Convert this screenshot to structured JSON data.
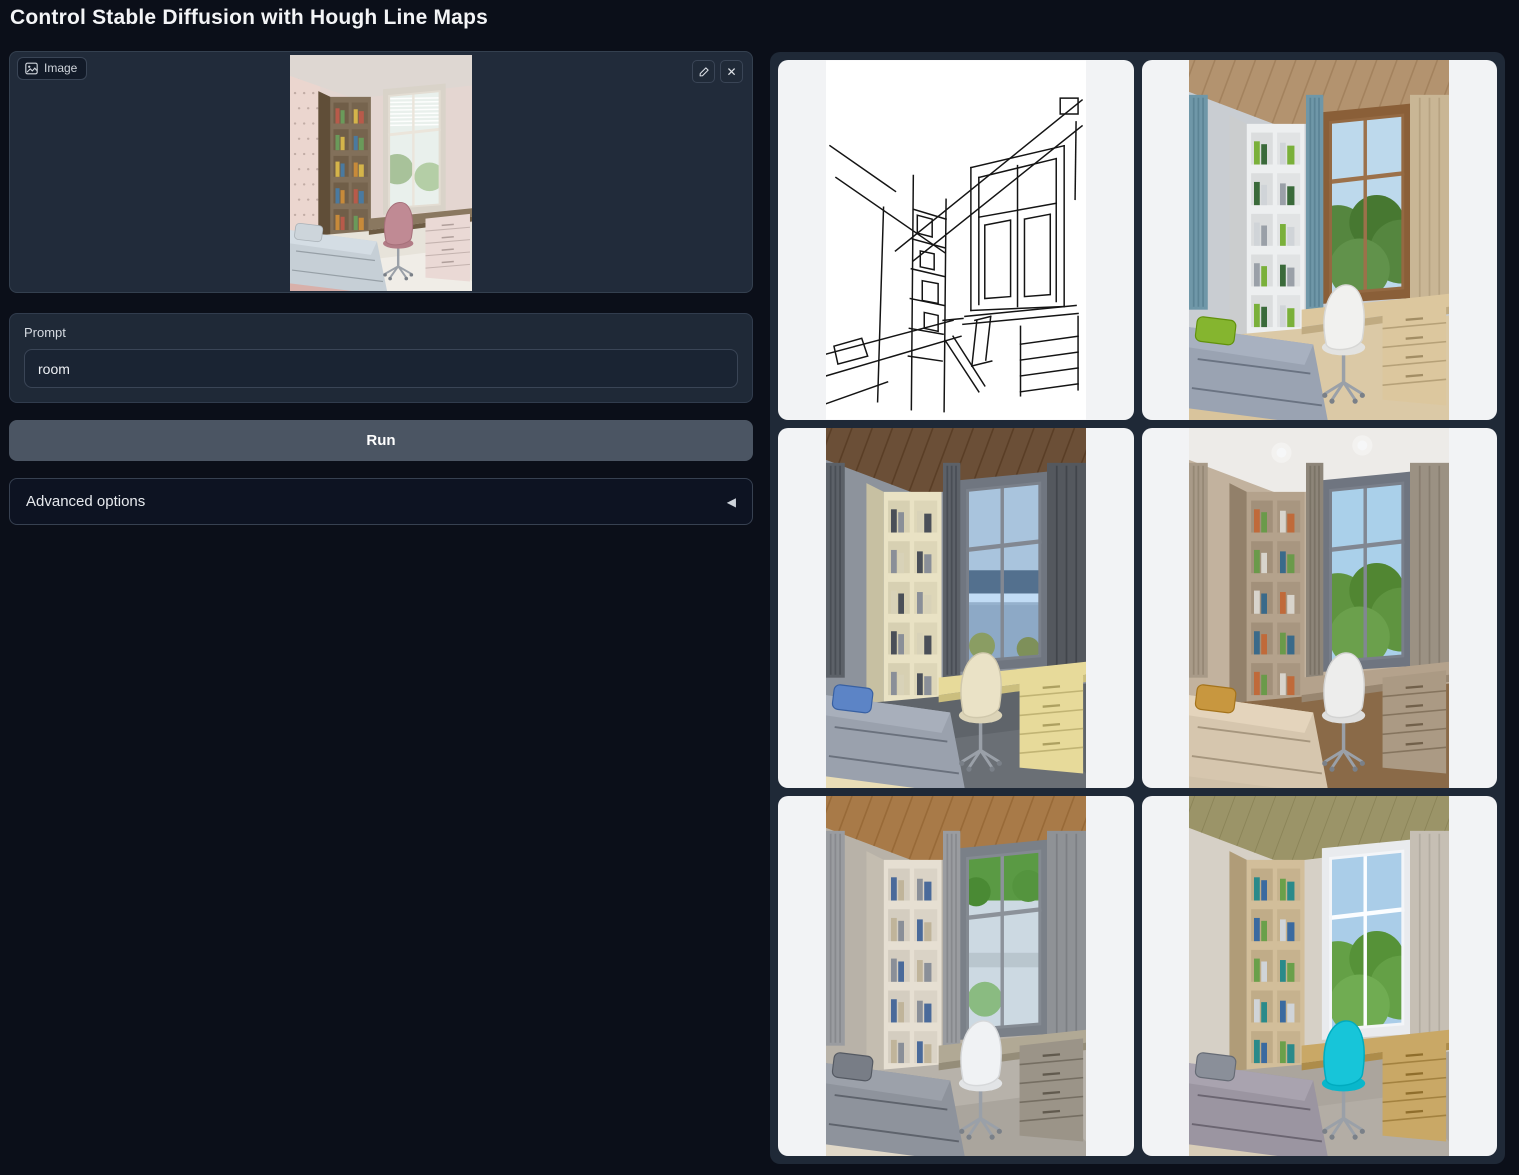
{
  "title": "Control Stable Diffusion with Hough Line Maps",
  "colors": {
    "page_bg": "#0b0f19",
    "block_bg": "#1f2937",
    "block_border": "#374151",
    "input_bg": "#1a2433",
    "run_button_bg": "#4b5563",
    "accordion_bg": "#0d1322",
    "gallery_bg": "#1f2937",
    "gallery_cell_bg": "#f2f3f5",
    "text_primary": "#f3f4f6",
    "text_secondary": "#d6dbe2"
  },
  "input_panel": {
    "image_label": "Image",
    "clear_glyph": "✕",
    "thumb_palette": {
      "wall": "#e4d6d1",
      "ceiling": "#ded7d2",
      "ceilingStyle": "flat",
      "lights": false,
      "wallpaper": "#ebd6cf",
      "edgeLeft": null,
      "curtainLeft": null,
      "curtainRight": null,
      "shelf": "#82705a",
      "books": [
        "#b85a4a",
        "#6a9a5a",
        "#d4b44a",
        "#4a7aa0",
        "#c78a3a"
      ],
      "frame": "#d9d3c9",
      "view1": "#e9f0ec",
      "view2": "#9cba8c",
      "viewStyle": "blinds",
      "desk": "#8a7860",
      "drawers": "#ead9d5",
      "chair": "#c08a94",
      "bed": "#c6cfd6",
      "bedFrame": "#d8b0aa",
      "pillow": "#cdd5db",
      "floor": "#e7e3da",
      "rug": "#f0ede7"
    }
  },
  "prompt": {
    "label": "Prompt",
    "value": "room"
  },
  "run_label": "Run",
  "advanced": {
    "label": "Advanced options",
    "collapse_glyph": "◀"
  },
  "gallery": {
    "items": [
      {
        "kind": "line-map",
        "name": "gallery-item-hough-line-map",
        "strokes": [
          "M10,118 L120,194",
          "M4,86 L70,132",
          "M70,192 L258,40",
          "M88,202 L258,66",
          "M236,38 h18 v16 h-18 z",
          "M252,62 L251,140",
          "M58,148 L52,344",
          "M88,116 L86,352",
          "M121,140 L119,354",
          "M88,150 L121,160",
          "M87,180 L120,189",
          "M86,210 L120,218",
          "M85,240 L119,247",
          "M84,270 L118,276",
          "M83,298 L117,303",
          "M92,156 l15,4 v18 l-15,-4 z",
          "M95,192 l14,3 v16 l-14,-3 z",
          "M97,222 l16,3 v20 l-16,-3 z",
          "M99,254 l14,3 v16 l-14,-3 z",
          "M146,108 L240,86",
          "M146,108 L146,252",
          "M240,86 L240,248",
          "M146,252 L240,248",
          "M154,118 L232,99",
          "M154,118 L154,246",
          "M232,99 L232,243",
          "M154,158 L232,144",
          "M193,106 L193,248",
          "M160,166 L186,161 M186,161 L186,238 M160,240 L186,238 M160,166 L160,240",
          "M200,160 L226,155 M226,155 L226,236 M200,238 L226,236 M200,160 L200,238",
          "M140,258 L252,247",
          "M138,266 L254,255",
          "M118,262 L138,260",
          "M196,268 L196,338",
          "M254,258 L254,332",
          "M196,286 L254,278",
          "M196,302 L254,294",
          "M196,318 L254,310",
          "M196,334 L254,326",
          "M0,296 L128,262",
          "M0,318 L136,278",
          "M0,346 L62,324",
          "M8,288 L36,280 L42,298 L12,306 z",
          "M120,282 L154,334",
          "M128,278 L160,328",
          "M150,262 l16,-4",
          "M152,262 L147,308",
          "M166,258 L161,302",
          "M147,308 l20,-5"
        ]
      },
      {
        "kind": "room",
        "name": "gallery-item-generated-room-1",
        "palette": {
          "wall": "#c9cdd2",
          "ceiling": "#b3936f",
          "ceilingStyle": "wood",
          "lights": false,
          "wallpaper": null,
          "edgeLeft": "#6f97a8",
          "curtainLeft": "#6f97a8",
          "curtainRight": "#c9b695",
          "shelf": "#edeff0",
          "books": [
            "#7ab03a",
            "#3a6a3a",
            "#d0d4d8",
            "#9aa0a8"
          ],
          "frame": "#8a5f38",
          "view1": "#bdd9ec",
          "view2": "#55863f",
          "viewStyle": "trees",
          "desk": "#dcc79e",
          "drawers": "#dcc79e",
          "chair": "#f1f1ef",
          "bed": "#9aa3b2",
          "bedFrame": "#d9c49c",
          "pillow": "#85b52f",
          "floor": "#dbc9a6",
          "rug": null
        }
      },
      {
        "kind": "room",
        "name": "gallery-item-generated-room-2",
        "palette": {
          "wall": "#8d939c",
          "ceiling": "#6b4f37",
          "ceilingStyle": "wood",
          "lights": false,
          "wallpaper": null,
          "edgeLeft": "#5c6168",
          "curtainLeft": "#5c6168",
          "curtainRight": "#54585e",
          "shelf": "#e9e2c4",
          "books": [
            "#4a4f58",
            "#8a8f98",
            "#d8d2b8"
          ],
          "frame": "#707680",
          "view1": "#a9c4dd",
          "view2": "#53708e",
          "viewStyle": "sea",
          "desk": "#e7da9a",
          "drawers": "#e7da9a",
          "chair": "#eae2c6",
          "bed": "#9aa1ad",
          "bedFrame": "#e9ddb6",
          "pillow": "#5c84c6",
          "floor": "#5f646a",
          "rug": "#6a6f75"
        }
      },
      {
        "kind": "room",
        "name": "gallery-item-generated-room-3",
        "palette": {
          "wall": "#c2b29e",
          "ceiling": "#edebe8",
          "ceilingStyle": "flat",
          "lights": true,
          "wallpaper": null,
          "edgeLeft": "#a89a88",
          "curtainLeft": "#8d8579",
          "curtainRight": "#9b9183",
          "shelf": "#b4a28c",
          "books": [
            "#c06a3a",
            "#6a9a4a",
            "#d8d4cc",
            "#3a6a8a"
          ],
          "frame": "#6f7580",
          "view1": "#aad0ea",
          "view2": "#5f9440",
          "viewStyle": "trees",
          "desk": "#b4a28c",
          "drawers": "#ab9a84",
          "chair": "#ededec",
          "bed": "#d6c6ae",
          "bedFrame": "#cfc0a8",
          "pillow": "#c8973f",
          "floor": "#8a6a48",
          "rug": null
        }
      },
      {
        "kind": "room",
        "name": "gallery-item-generated-room-4",
        "palette": {
          "wall": "#b8b2a8",
          "ceiling": "#a87a48",
          "ceilingStyle": "wood",
          "lights": false,
          "wallpaper": null,
          "edgeLeft": "#9a9ca0",
          "curtainLeft": "#9a9ca0",
          "curtainRight": "#8f9296",
          "shelf": "#e6dfd2",
          "books": [
            "#4a6a9a",
            "#c0b49a",
            "#8a8f98"
          ],
          "frame": "#7a8088",
          "view1": "#ccd9e2",
          "view2": "#5a9a44",
          "viewStyle": "valley",
          "desk": "#b1a995",
          "drawers": "#9b9488",
          "chair": "#f0f2f4",
          "bed": "#8e939c",
          "bedFrame": "#e0d8c8",
          "pillow": "#787d86",
          "floor": "#b7b2aa",
          "rug": "#aaa59d"
        }
      },
      {
        "kind": "room",
        "name": "gallery-item-generated-room-5",
        "palette": {
          "wall": "#d6d0c6",
          "ceiling": "#9b9468",
          "ceilingStyle": "olive",
          "lights": false,
          "wallpaper": null,
          "edgeLeft": null,
          "curtainLeft": null,
          "curtainRight": "#c6bfb4",
          "shelf": "#d2be9a",
          "books": [
            "#2a8a8a",
            "#3a6aa0",
            "#6aa04a",
            "#d0d4d8"
          ],
          "frame": "#e9ebee",
          "view1": "#aacde8",
          "view2": "#64a046",
          "viewStyle": "trees",
          "desk": "#c9a866",
          "drawers": "#c9a866",
          "chair": "#17c5d9",
          "bed": "#9b95a1",
          "bedFrame": "#d8cdb8",
          "pillow": "#8a8f99",
          "floor": "#aba59d",
          "rug": "#b3ada5"
        }
      }
    ]
  }
}
